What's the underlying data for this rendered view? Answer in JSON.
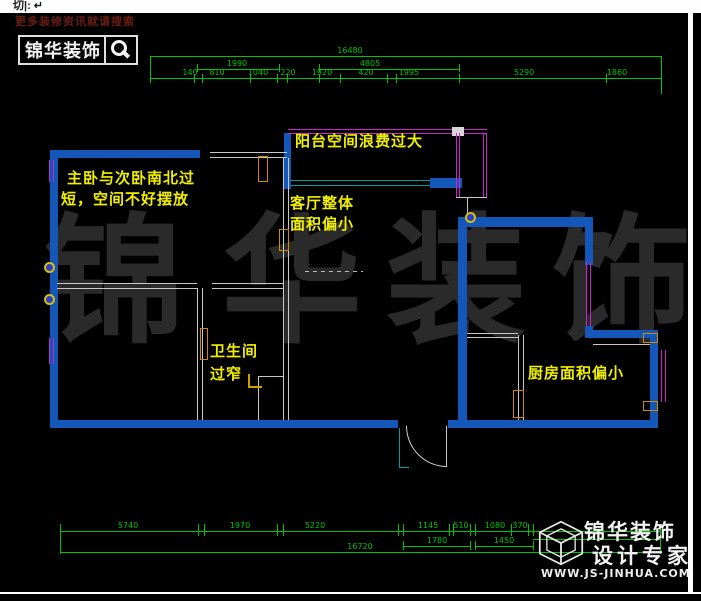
{
  "window": {
    "command_line": "切|:  ↵"
  },
  "branding_top": {
    "promo": "更多装修资讯就请搜索",
    "logo": "锦华装饰"
  },
  "watermark": [
    "锦",
    "华",
    "装",
    "饰"
  ],
  "notes": {
    "bedroom_l1": "主卧与次卧南北过",
    "bedroom_l2": "短，空间不好摆放",
    "balcony": "阳台空间浪费过大",
    "living_l1": "客厅整体",
    "living_l2": "面积偏小",
    "bath_l1": "卫生间",
    "bath_l2": "过窄",
    "kitchen": "厨房面积偏小"
  },
  "dims_top": {
    "overall": "16480",
    "g1": "1990",
    "g2": "4805",
    "d1": "140",
    "d2": "810",
    "d3": "1040",
    "d4": "220",
    "d5": "1920",
    "d6": "420",
    "d7": "1995",
    "d8": "5290",
    "d9": "1860"
  },
  "dims_bottom": {
    "overall": "16720",
    "d1": "5740",
    "d2": "1970",
    "d3": "5220",
    "d4": "1145",
    "d5": "510",
    "d6": "1080",
    "d7": "370",
    "g1": "1780",
    "g2": "1450"
  },
  "branding_bottom": {
    "line1": "锦华装饰",
    "line2": "设计专家",
    "url": "WWW.JS-JINHUA.COM"
  },
  "colors": {
    "wall_blue": "#1457b8",
    "window_magenta": "#cc22cc",
    "dim_green": "#00c400",
    "note_yellow": "#f0ef00",
    "balcony_cyan": "#00a0a0",
    "door_orange": "#d08a00",
    "watermark_gray": "#2a2a2a"
  }
}
